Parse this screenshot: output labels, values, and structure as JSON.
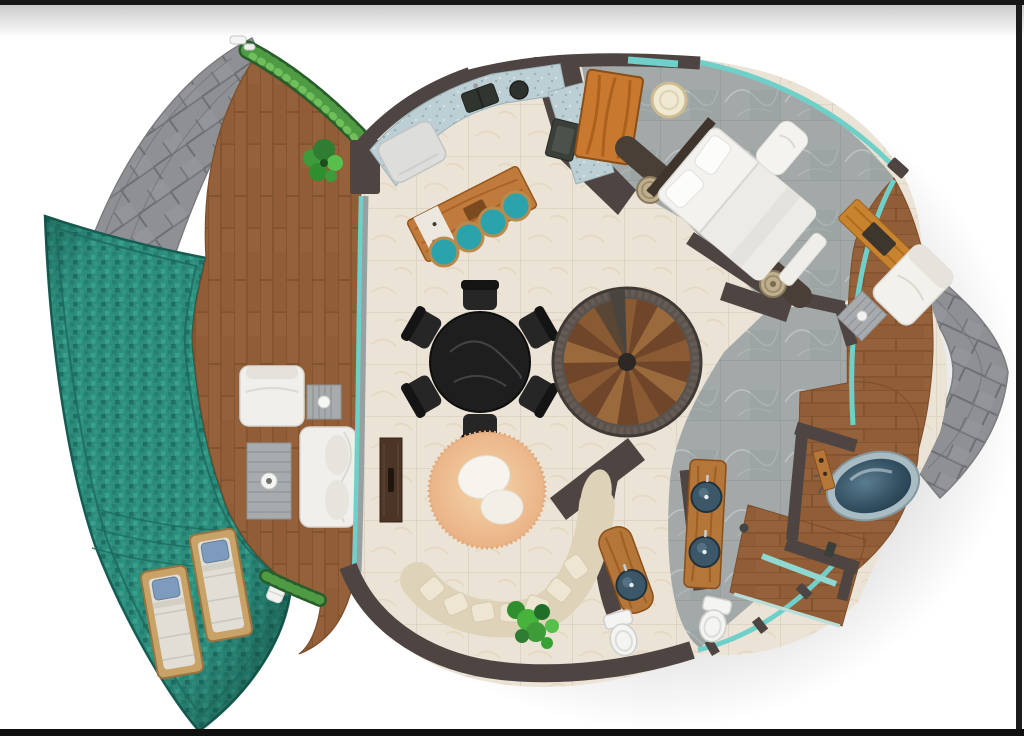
{
  "meta": {
    "description": "Top-down rendered floor plan of a circular resort villa: lagoon pool with in-water loungers, wooden sun deck with outdoor lounge furniture, open living room with bar island, round dining table, spiral staircase, bedroom with king bed and desk deck, bathroom with freestanding tub, shower room, double vanity, powder room, stone paver paths and vine hedges",
    "view": "top-down 3D floor plan",
    "visible_text": []
  },
  "elements": {
    "pool_loungers": 2,
    "deck_sofa_seats": 1,
    "bar_stools": 4,
    "dining_chairs": 6,
    "spiral_stair_treads": 18,
    "beds": 1,
    "nightstands": 2,
    "toilets": 2,
    "bathroom_vanity_sinks": 2,
    "powder_room_sinks": 1,
    "freestanding_tubs": 1,
    "plants": 3,
    "vine_hedges": 2
  },
  "palette": {
    "frame": "#161616",
    "bg": "#ffffff",
    "stone": "#8f9094",
    "stone_line": "#6e6f73",
    "pool": "#2d8d7d",
    "pool_border": "#175c52",
    "deck_wood": "#95613a",
    "deck_wood_line": "#7c4e2b",
    "tile": "#ebe3d5",
    "tile_line": "#d8cdbb",
    "marble": "#a2a9a8",
    "marble_line": "#909695",
    "wall": "#4e4543",
    "wall_band": "#4a3f37",
    "glass": "#6fd0c9",
    "counter": "#bccfd4",
    "island": "#c07a3c",
    "stool": "#2ba3ad",
    "stool_rim": "#b98a4e",
    "dining": "#1e1e1e",
    "stair_wood": "#8a5a33",
    "stair_wood_dark": "#70462a",
    "stair_rim": "#5a534d",
    "rug": "#eec394",
    "sofa": "#ded2b8",
    "pillow": "#eee6d2",
    "white_f": "#f0efeb",
    "gray_f": "#a7abae",
    "bed": "#f3f2ee",
    "wardrobe": "#c8792f",
    "vanity": "#b5763a",
    "sink": "#3c5868",
    "toilet": "#f4f4f2",
    "tub_rim": "#a9bcc4",
    "vine": "#295e2c",
    "vine_light": "#4f9b44",
    "plant": "#3e9b3a",
    "lounger_frame": "#c9a268",
    "lounger_pillow": "#7d9bbd"
  }
}
